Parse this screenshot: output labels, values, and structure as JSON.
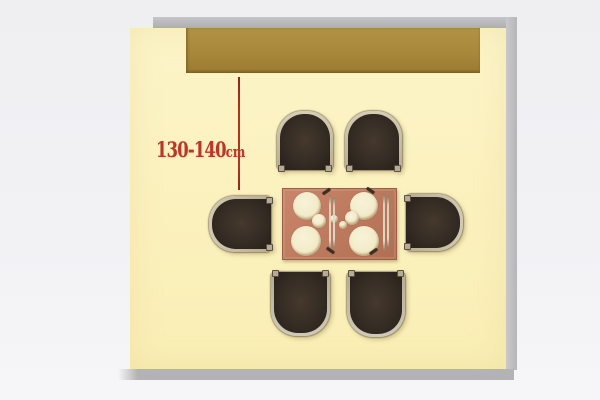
{
  "annotation": {
    "value": "130-140",
    "unit": "cm",
    "color": "#bb3627"
  },
  "colors": {
    "background": "#f1f1f4",
    "floor": "#fbf1bd",
    "wall_shadow": "#b3b3b6",
    "sideboard": "#a8883a",
    "dimension_line": "#b23322",
    "table_top": "#bd7a5e",
    "plate": "#f2ebc8",
    "chair_seat": "#352c24",
    "chair_rim": "#c9bfa8"
  },
  "diagram": {
    "floor": {
      "x": 130,
      "y": 28,
      "w": 376,
      "h": 341
    },
    "wall_strips": {
      "top": {
        "x": 153,
        "y": 17,
        "w": 364,
        "h": 11
      },
      "right": {
        "x": 506,
        "y": 17,
        "w": 11,
        "h": 353
      },
      "bottom": {
        "x": 118,
        "y": 369,
        "w": 396,
        "h": 11
      }
    },
    "sideboard": {
      "x": 186,
      "y": 28,
      "w": 294,
      "h": 45
    },
    "dimension_line": {
      "x": 238,
      "y1": 77,
      "y2": 190
    },
    "label_pos": {
      "x": 156,
      "y": 139
    },
    "table": {
      "x": 282,
      "y": 188,
      "w": 113,
      "h": 70
    },
    "plates": [
      {
        "cx": 307,
        "cy": 206,
        "r": 14
      },
      {
        "cx": 364,
        "cy": 206,
        "r": 14
      },
      {
        "cx": 306,
        "cy": 241,
        "r": 15
      },
      {
        "cx": 364,
        "cy": 241,
        "r": 15
      },
      {
        "cx": 319,
        "cy": 221,
        "r": 7
      },
      {
        "cx": 352,
        "cy": 218,
        "r": 7
      },
      {
        "cx": 334,
        "cy": 219,
        "r": 4
      },
      {
        "cx": 343,
        "cy": 225,
        "r": 4
      }
    ],
    "utensils": [
      {
        "x": 329,
        "y": 195,
        "len": 55
      },
      {
        "x": 333,
        "y": 197,
        "len": 51
      },
      {
        "x": 383,
        "y": 194,
        "len": 57
      },
      {
        "x": 387,
        "y": 196,
        "len": 52
      }
    ],
    "cutlery_marks": [
      {
        "x": 322,
        "y": 190,
        "rot": -35
      },
      {
        "x": 366,
        "y": 189,
        "rot": 35
      },
      {
        "x": 326,
        "y": 249,
        "rot": 215
      },
      {
        "x": 369,
        "y": 250,
        "rot": 145
      }
    ],
    "chairs": [
      {
        "id": "top-left",
        "side": "top",
        "x": 277,
        "y": 111,
        "w": 56,
        "h": 59
      },
      {
        "id": "top-right",
        "side": "top",
        "x": 345,
        "y": 111,
        "w": 57,
        "h": 59
      },
      {
        "id": "left",
        "side": "left",
        "x": 209,
        "y": 196,
        "w": 62,
        "h": 56
      },
      {
        "id": "right",
        "side": "right",
        "x": 406,
        "y": 194,
        "w": 57,
        "h": 57
      },
      {
        "id": "bottom-left",
        "side": "bottom",
        "x": 271,
        "y": 272,
        "w": 59,
        "h": 64
      },
      {
        "id": "bottom-right",
        "side": "bottom",
        "x": 347,
        "y": 272,
        "w": 58,
        "h": 65
      }
    ]
  }
}
